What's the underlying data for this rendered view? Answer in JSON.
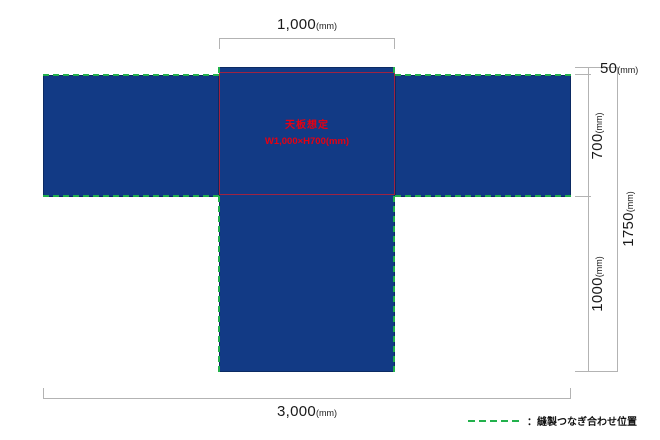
{
  "diagram_type": "sewing-layout-t-shape-table-cloth",
  "colors": {
    "fabric_blue": "#123a85",
    "fabric_edge_navy": "#0b2a63",
    "seam_green": "#22b14c",
    "tabletop_outline_red": "#9e2342",
    "tabletop_text_red": "#e60012",
    "dimension_line_gray": "#b3b3b3"
  },
  "labels": {
    "top_width": {
      "value": "1,000",
      "unit": "(mm)"
    },
    "offset_top": {
      "value": "50",
      "unit": "(mm)"
    },
    "depth": {
      "value": "700",
      "unit": "(mm)"
    },
    "front_drop": {
      "value": "1000",
      "unit": "(mm)"
    },
    "total_height": {
      "value": "1750",
      "unit": "(mm)"
    },
    "total_width": {
      "value": "3,000",
      "unit": "(mm)"
    }
  },
  "tabletop": {
    "line1": "天板想定",
    "line2": "W1,000×H700(mm)"
  },
  "legend": {
    "label": "：縫製つなぎ合わせ位置"
  }
}
